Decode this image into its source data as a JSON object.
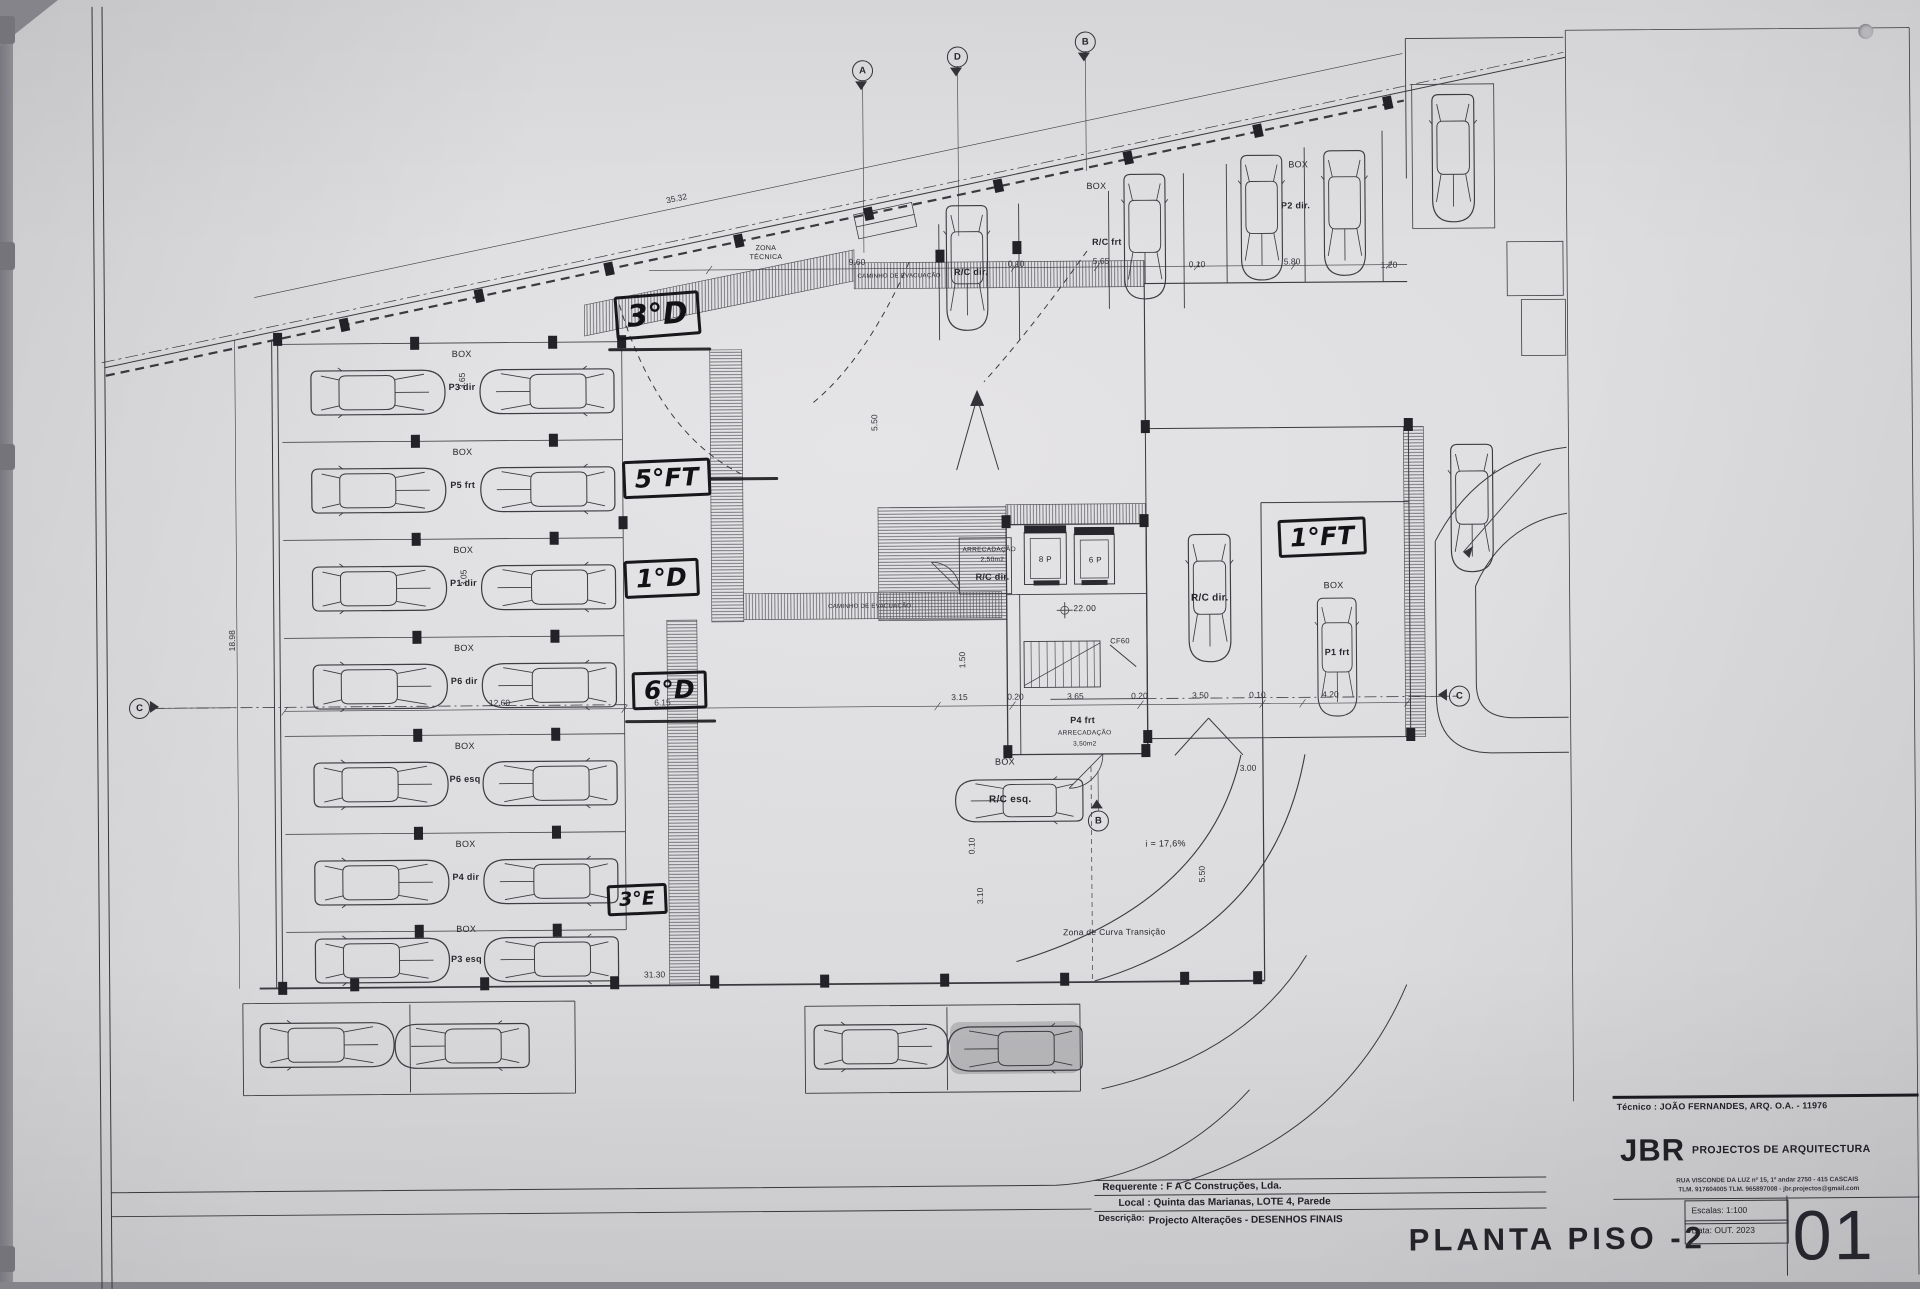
{
  "title_block": {
    "tecnico": "Técnico : JOÃO FERNANDES, ARQ.   O.A. - 11976",
    "firm_short": "JBR",
    "firm_name": "PROJECTOS DE ARQUITECTURA",
    "firm_address": "RUA VISCONDE DA LUZ nº 15, 1º andar  2750 - 415  CASCAIS",
    "firm_contacts": "TLM. 917604005  TLM. 965897008 - jbr.projectos@gmail.com",
    "requerente": "Requerente : F A C  Construções, Lda.",
    "local": "Local : Quinta das Marianas, LOTE 4, Parede",
    "descricao_label": "Descrição:",
    "descricao": "Projecto Alterações - DESENHOS FINAIS",
    "drawing_title": "PLANTA PISO -2",
    "escalas": "Escalas:  1:100",
    "data": "Data:  OUT. 2023",
    "sheet_number": "01"
  },
  "handwritten_labels": [
    {
      "t": "3°D",
      "x": 648,
      "y": 313,
      "fs": 30,
      "r": -4
    },
    {
      "t": "5°FT",
      "x": 656,
      "y": 476,
      "fs": 25,
      "r": -2
    },
    {
      "t": "1°D",
      "x": 650,
      "y": 576,
      "fs": 25,
      "r": -2
    },
    {
      "t": "6°D",
      "x": 657,
      "y": 688,
      "fs": 25,
      "r": -1
    },
    {
      "t": "3°E",
      "x": 623,
      "y": 897,
      "fs": 19,
      "r": -2
    },
    {
      "t": "1°FT",
      "x": 1311,
      "y": 540,
      "fs": 25,
      "r": -2
    }
  ],
  "plan_labels": [
    {
      "t": "BOX",
      "x": 452,
      "y": 350
    },
    {
      "t": "P3 dir",
      "x": 452,
      "y": 383,
      "b": 1
    },
    {
      "t": "BOX",
      "x": 452,
      "y": 448
    },
    {
      "t": "P5 frt",
      "x": 452,
      "y": 481,
      "b": 1
    },
    {
      "t": "BOX",
      "x": 452,
      "y": 546
    },
    {
      "t": "P1 dir",
      "x": 452,
      "y": 579,
      "b": 1
    },
    {
      "t": "BOX",
      "x": 452,
      "y": 644
    },
    {
      "t": "P6 dir",
      "x": 452,
      "y": 677,
      "b": 1
    },
    {
      "t": "BOX",
      "x": 452,
      "y": 742
    },
    {
      "t": "P6 esq",
      "x": 452,
      "y": 775,
      "b": 1
    },
    {
      "t": "BOX",
      "x": 452,
      "y": 840
    },
    {
      "t": "P4 dir",
      "x": 452,
      "y": 873,
      "b": 1
    },
    {
      "t": "BOX",
      "x": 452,
      "y": 925
    },
    {
      "t": "P3 esq",
      "x": 452,
      "y": 955,
      "b": 1
    },
    {
      "t": "BOX",
      "x": 1088,
      "y": 187
    },
    {
      "t": "R/C frt",
      "x": 1098,
      "y": 243,
      "b": 1
    },
    {
      "t": "BOX",
      "x": 1290,
      "y": 167
    },
    {
      "t": "P2 dir.",
      "x": 1287,
      "y": 208,
      "b": 1
    },
    {
      "t": "R/C dir.",
      "x": 962,
      "y": 272,
      "b": 1
    },
    {
      "t": "BOX",
      "x": 992,
      "y": 762
    },
    {
      "t": "R/C esq.",
      "x": 997,
      "y": 800,
      "b": 1,
      "s": 10
    },
    {
      "t": "BOX",
      "x": 1322,
      "y": 588
    },
    {
      "t": "P1 frt",
      "x": 1325,
      "y": 655,
      "b": 1
    },
    {
      "t": "R/C dir.",
      "x": 1198,
      "y": 600,
      "b": 1,
      "s": 10
    },
    {
      "t": "ARRECADAÇÃO",
      "x": 978,
      "y": 550,
      "s": 6.5
    },
    {
      "t": "2,50m2",
      "x": 981,
      "y": 560,
      "s": 6.5
    },
    {
      "t": "R/C dir.",
      "x": 981,
      "y": 577,
      "b": 1
    },
    {
      "t": "8 P",
      "x": 1034,
      "y": 560,
      "s": 8
    },
    {
      "t": "6 P",
      "x": 1084,
      "y": 561,
      "s": 8
    },
    {
      "t": "22.00",
      "x": 1073,
      "y": 609,
      "s": 8.5
    },
    {
      "t": "CF60",
      "x": 1108,
      "y": 642,
      "s": 7.5
    },
    {
      "t": "P4 frt",
      "x": 1070,
      "y": 721,
      "b": 1
    },
    {
      "t": "ARRECADAÇÃO",
      "x": 1072,
      "y": 734,
      "s": 6.5
    },
    {
      "t": "3,50m2",
      "x": 1072,
      "y": 745,
      "s": 6.5
    },
    {
      "t": "ZONA",
      "x": 757,
      "y": 247,
      "s": 7
    },
    {
      "t": "TÉCNICA",
      "x": 757,
      "y": 256,
      "s": 7
    },
    {
      "t": "CAMINHO DE EVACUAÇÃO",
      "x": 890,
      "y": 276,
      "s": 6
    },
    {
      "t": "CAMINHO DE EVACUAÇÃO",
      "x": 858,
      "y": 606,
      "s": 6
    },
    {
      "t": "i = 17,6%",
      "x": 1152,
      "y": 845,
      "s": 9
    },
    {
      "t": "Zona de Curva Transição",
      "x": 1100,
      "y": 933,
      "s": 8.5
    }
  ],
  "dimensions": [
    {
      "t": "35.32",
      "x": 668,
      "y": 196,
      "r": -11.5
    },
    {
      "t": "9.60",
      "x": 848,
      "y": 261
    },
    {
      "t": "0.10",
      "x": 1007,
      "y": 264
    },
    {
      "t": "5.65",
      "x": 1092,
      "y": 262
    },
    {
      "t": "0.10",
      "x": 1188,
      "y": 266
    },
    {
      "t": "5.80",
      "x": 1283,
      "y": 264
    },
    {
      "t": "1.20",
      "x": 1380,
      "y": 268
    },
    {
      "t": "12.60",
      "x": 487,
      "y": 699
    },
    {
      "t": "6.15",
      "x": 650,
      "y": 700
    },
    {
      "t": "3.15",
      "x": 947,
      "y": 697
    },
    {
      "t": "0.20",
      "x": 1003,
      "y": 697
    },
    {
      "t": "3.65",
      "x": 1063,
      "y": 697
    },
    {
      "t": "0.20",
      "x": 1127,
      "y": 697
    },
    {
      "t": "3.50",
      "x": 1188,
      "y": 697
    },
    {
      "t": "0.10",
      "x": 1245,
      "y": 697
    },
    {
      "t": "4.20",
      "x": 1318,
      "y": 697
    },
    {
      "t": "31.30",
      "x": 640,
      "y": 972
    },
    {
      "t": "18.98",
      "x": 220,
      "y": 635,
      "r": -90
    },
    {
      "t": "3.65",
      "x": 452,
      "y": 377,
      "r": -90
    },
    {
      "t": "3.05",
      "x": 452,
      "y": 574,
      "r": -90
    },
    {
      "t": "5.50",
      "x": 864,
      "y": 422,
      "r": -90
    },
    {
      "t": "1.50",
      "x": 950,
      "y": 660,
      "r": -90
    },
    {
      "t": "0.10",
      "x": 958,
      "y": 846,
      "r": -90
    },
    {
      "t": "3.10",
      "x": 966,
      "y": 896,
      "r": -90
    },
    {
      "t": "3.00",
      "x": 1235,
      "y": 770
    },
    {
      "t": "5.50",
      "x": 1188,
      "y": 876,
      "r": -90
    }
  ],
  "section_markers": [
    {
      "t": "A",
      "x": 855,
      "y": 70,
      "dir": "down"
    },
    {
      "t": "D",
      "x": 950,
      "y": 57,
      "dir": "down"
    },
    {
      "t": "B",
      "x": 1078,
      "y": 43,
      "dir": "down"
    },
    {
      "t": "C",
      "x": 127,
      "y": 702,
      "dir": "right"
    },
    {
      "t": "C",
      "x": 1447,
      "y": 700,
      "dir": "left"
    },
    {
      "t": "B",
      "x": 1085,
      "y": 822,
      "dir": "up"
    }
  ],
  "cars": [
    {
      "x": 368,
      "y": 388,
      "r": 0
    },
    {
      "x": 537,
      "y": 388,
      "r": 180
    },
    {
      "x": 368,
      "y": 486,
      "r": 0
    },
    {
      "x": 537,
      "y": 486,
      "r": 180
    },
    {
      "x": 368,
      "y": 584,
      "r": 0
    },
    {
      "x": 537,
      "y": 584,
      "r": 180
    },
    {
      "x": 368,
      "y": 682,
      "r": 0
    },
    {
      "x": 537,
      "y": 682,
      "r": 180
    },
    {
      "x": 368,
      "y": 780,
      "r": 0
    },
    {
      "x": 537,
      "y": 780,
      "r": 180
    },
    {
      "x": 368,
      "y": 878,
      "r": 0
    },
    {
      "x": 537,
      "y": 878,
      "r": 180
    },
    {
      "x": 368,
      "y": 956,
      "r": 0
    },
    {
      "x": 537,
      "y": 956,
      "r": 180
    },
    {
      "x": 958,
      "y": 268,
      "r": 90,
      "s": 0.93
    },
    {
      "x": 1136,
      "y": 238,
      "r": 90,
      "s": 0.93
    },
    {
      "x": 1253,
      "y": 220,
      "r": 90,
      "s": 0.93
    },
    {
      "x": 1336,
      "y": 216,
      "r": 90,
      "s": 0.93
    },
    {
      "x": 1445,
      "y": 162,
      "r": 90,
      "s": 0.95
    },
    {
      "x": 1198,
      "y": 600,
      "r": 90,
      "s": 0.95
    },
    {
      "x": 1325,
      "y": 660,
      "r": 90,
      "s": 0.88
    },
    {
      "x": 1461,
      "y": 512,
      "r": 90,
      "s": 0.95
    },
    {
      "x": 1006,
      "y": 801,
      "r": 180,
      "s": 0.95
    },
    {
      "x": 312,
      "y": 1040,
      "r": 0
    },
    {
      "x": 447,
      "y": 1042,
      "r": 180
    },
    {
      "x": 866,
      "y": 1046,
      "r": 0
    },
    {
      "x": 1000,
      "y": 1049,
      "r": 180
    }
  ],
  "columns": [
    {
      "x": 405,
      "y": 339
    },
    {
      "x": 405,
      "y": 437
    },
    {
      "x": 405,
      "y": 535
    },
    {
      "x": 405,
      "y": 633
    },
    {
      "x": 405,
      "y": 731
    },
    {
      "x": 405,
      "y": 829
    },
    {
      "x": 405,
      "y": 927
    },
    {
      "x": 543,
      "y": 339
    },
    {
      "x": 543,
      "y": 437
    },
    {
      "x": 543,
      "y": 535
    },
    {
      "x": 543,
      "y": 633
    },
    {
      "x": 543,
      "y": 731
    },
    {
      "x": 543,
      "y": 829
    },
    {
      "x": 543,
      "y": 927
    },
    {
      "x": 335,
      "y": 320,
      "r": -11.5
    },
    {
      "x": 470,
      "y": 292,
      "r": -11.5
    },
    {
      "x": 600,
      "y": 266,
      "r": -11.5
    },
    {
      "x": 730,
      "y": 239,
      "r": -11.5
    },
    {
      "x": 860,
      "y": 213,
      "r": -11.5
    },
    {
      "x": 990,
      "y": 186,
      "r": -11.5
    },
    {
      "x": 1120,
      "y": 159,
      "r": -11.5
    },
    {
      "x": 1250,
      "y": 133,
      "r": -11.5
    },
    {
      "x": 1380,
      "y": 106,
      "r": -11.5
    },
    {
      "x": 340,
      "y": 980
    },
    {
      "x": 470,
      "y": 980
    },
    {
      "x": 600,
      "y": 980
    },
    {
      "x": 700,
      "y": 980
    },
    {
      "x": 810,
      "y": 980
    },
    {
      "x": 930,
      "y": 980
    },
    {
      "x": 1050,
      "y": 980
    },
    {
      "x": 1170,
      "y": 980
    },
    {
      "x": 1243,
      "y": 980
    },
    {
      "x": 931,
      "y": 256
    },
    {
      "x": 1008,
      "y": 248
    },
    {
      "x": 995,
      "y": 522
    },
    {
      "x": 1133,
      "y": 522
    },
    {
      "x": 995,
      "y": 752
    },
    {
      "x": 1133,
      "y": 752
    },
    {
      "x": 1135,
      "y": 428
    },
    {
      "x": 1398,
      "y": 428
    },
    {
      "x": 1135,
      "y": 738
    },
    {
      "x": 1398,
      "y": 738
    },
    {
      "x": 612,
      "y": 339
    },
    {
      "x": 612,
      "y": 520
    },
    {
      "x": 268,
      "y": 334
    },
    {
      "x": 268,
      "y": 983
    }
  ]
}
